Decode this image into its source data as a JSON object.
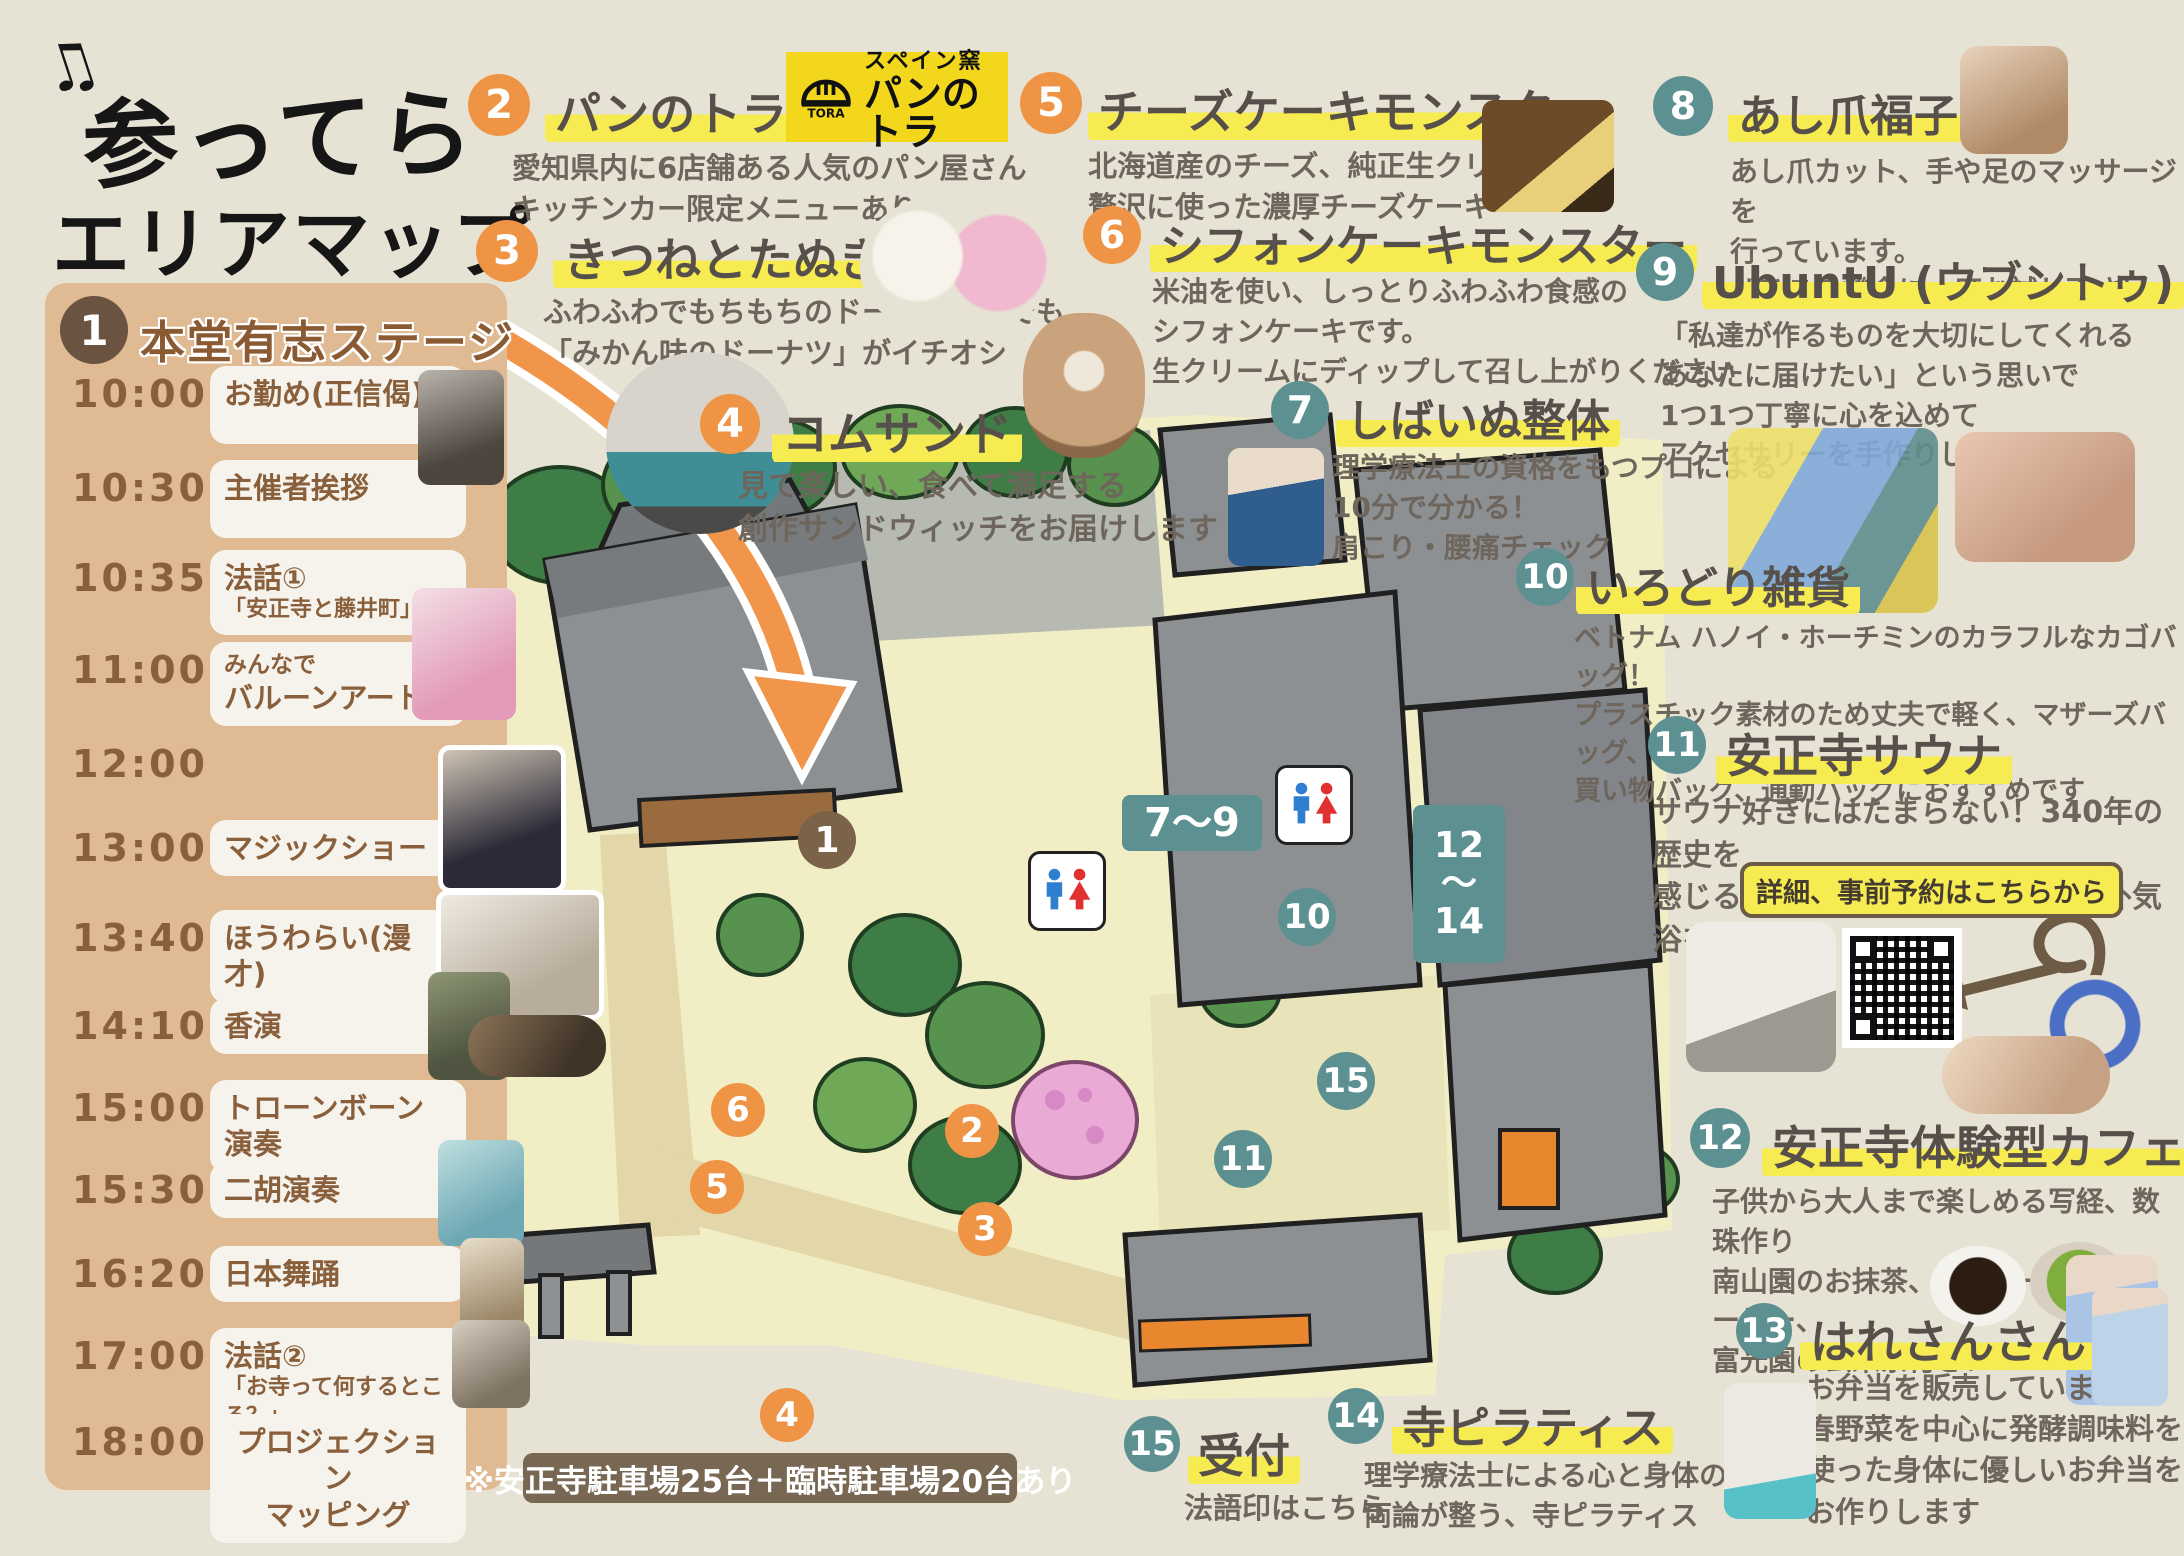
{
  "title": {
    "note1": "♫",
    "line1": "参ってら",
    "line2": "エリアマップ",
    "note2": "♪"
  },
  "colors": {
    "orange": "#ef9445",
    "teal": "#5d9191",
    "brown": "#6b5342",
    "highlight": "#f6ec52",
    "panel": "#dfba92",
    "background": "#e7e3d4",
    "logo_yellow": "#f3d71c",
    "map_ground": "#f1eec6"
  },
  "schedule": {
    "number": "1",
    "title": "本堂有志ステージ",
    "rows": [
      {
        "time": "10:00",
        "label": "お勤め(正信偈)"
      },
      {
        "time": "10:30",
        "label": "主催者挨拶"
      },
      {
        "time": "10:35",
        "label": "法話①",
        "sub": "「安正寺と藤井町」"
      },
      {
        "time": "11:00",
        "pre": "みんなで",
        "label": "バルーンアート"
      },
      {
        "time": "12:00",
        "label": ""
      },
      {
        "time": "13:00",
        "label": "マジックショー"
      },
      {
        "time": "13:40",
        "label": "ほうわらい(漫才)"
      },
      {
        "time": "14:10",
        "label": "香演"
      },
      {
        "time": "15:00",
        "label": "トローンボーン演奏"
      },
      {
        "time": "15:30",
        "label": "二胡演奏"
      },
      {
        "time": "16:20",
        "label": "日本舞踊"
      },
      {
        "time": "17:00",
        "label": "法話②",
        "sub": "「お寺って何するところ？」"
      },
      {
        "time": "18:00",
        "label": "プロジェクション\nマッピング"
      }
    ]
  },
  "vendors": [
    {
      "number": "2",
      "name": "パンのトラ",
      "desc": "愛知県内に6店舗ある人気のパン屋さん\nキッチンカー限定メニューあります",
      "logo": {
        "tora": "TORA",
        "kiln": "スペイン窯",
        "name": "パンのトラ"
      }
    },
    {
      "number": "3",
      "name": "きつねとたぬき",
      "desc": "ふわふわでもちもちのドーナツの中でも\n「みかん味のドーナツ」がイチオシ"
    },
    {
      "number": "4",
      "name": "コムサンド",
      "desc": "見て楽しい、食べて満足する\n創作サンドウィッチをお届けします"
    },
    {
      "number": "5",
      "name": "チーズケーキモンスター",
      "desc": "北海道産のチーズ、純正生クリームを\n贅沢に使った濃厚チーズケーキ"
    },
    {
      "number": "6",
      "name": "シフォンケーキモンスター",
      "desc": "米油を使い、しっとりふわふわ食感の\nシフォンケーキです。\n生クリームにディップして召し上がりください"
    },
    {
      "number": "7",
      "name": "しばいぬ整体",
      "desc": "理学療法士の資格をもつプロによる\n10分で分かる！\n肩こり・腰痛チェック"
    },
    {
      "number": "8",
      "name": "あし爪福子",
      "desc": "あし爪カット、手や足のマッサージを\n行っています。\nぜひこの機会に一度お試し下さい"
    },
    {
      "number": "9",
      "name": "UbuntU (ウブントゥ)",
      "desc": "「私達が作るものを大切にしてくれる\nあなたに届けたい」という思いで\n1つ1つ丁寧に心を込めて\nアクセサリーを手作りしています"
    },
    {
      "number": "10",
      "name": "いろどり雑貨",
      "desc": "ベトナム ハノイ・ホーチミンのカラフルなカゴバッグ！\nプラスチック素材のため丈夫で軽く、マザーズバッグ、\n買い物バッグ、通勤バッグにおすすめです"
    },
    {
      "number": "11",
      "name": "安正寺サウナ",
      "desc": "サウナ好きにはたまらない！340年の歴史を\n感じる、お寺の境内で整う最高の外気浴を！",
      "booking": "詳細、事前予約はこちらから"
    },
    {
      "number": "12",
      "name": "安正寺体験型カフェ",
      "desc": "子供から大人まで楽しめる写経、数珠作り\n南山園のお抹茶、ベルコーヒーのコーヒー、\n富光園の玄米茶付き！"
    },
    {
      "number": "13",
      "name": "はれさんさん",
      "desc": "お弁当を販売しています\n春野菜を中心に発酵調味料を\n使った身体に優しいお弁当を\nお作りします"
    },
    {
      "number": "14",
      "name": "寺ピラティス",
      "desc": "理学療法士による心と身体の\n両論が整う、寺ピラティス"
    },
    {
      "number": "15",
      "name": "受付",
      "desc": "法語印はこちら"
    }
  ],
  "map": {
    "markers": [
      "1",
      "2",
      "3",
      "4",
      "5",
      "6",
      "10",
      "11",
      "15"
    ],
    "ranges": [
      "7～9",
      "12\n～\n14"
    ]
  },
  "parking_note": "※安正寺駐車場25台＋臨時駐車場20台あり"
}
